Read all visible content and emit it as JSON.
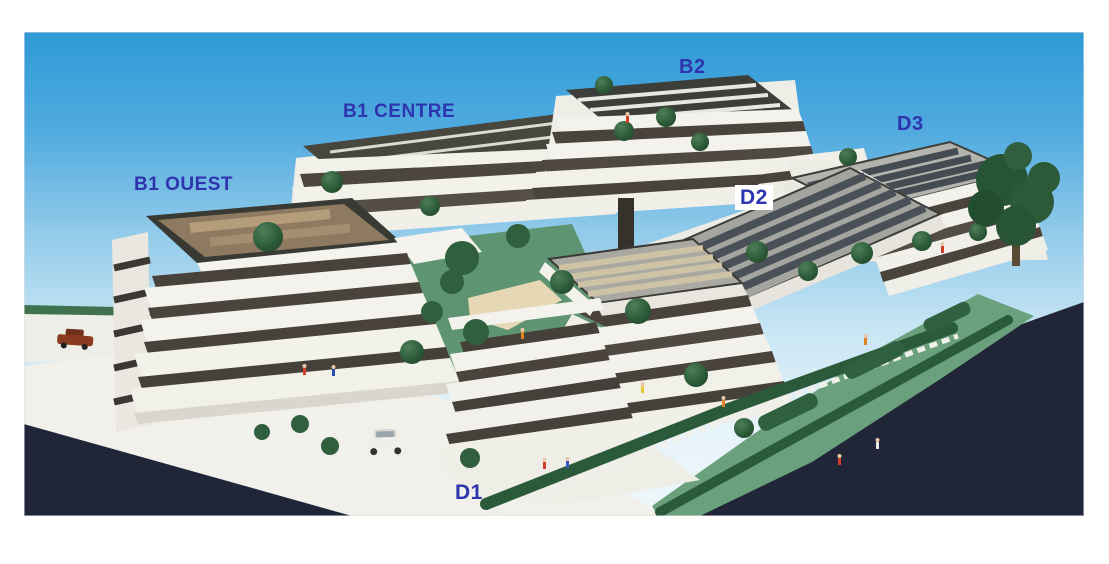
{
  "photo": {
    "description": "Photograph of an architectural scale model of a terraced apartment complex with labelled buildings",
    "labels": {
      "b1_ouest": "B1 OUEST",
      "b1_centre": "B1 CENTRE",
      "b2": "B2",
      "d2": "D2",
      "d3": "D3",
      "d1": "D1"
    },
    "label_style": "color:#2e34ae",
    "colors": {
      "label_blue": "#2e34ae",
      "sky_top": "#2f9ad6",
      "sky_mid": "#93cbea",
      "sky_horizon": "#edf7fb",
      "ground_dark": "#202638",
      "building_white": "#f3f2ec",
      "window_dark": "#48423a",
      "roof_deck_brown": "#8d7a60",
      "solar_panel": "#4a5058",
      "tree_green": "#2c5a38",
      "lawn_green": "#6aa07c",
      "hedge_green": "#2b5a3a",
      "sand_path": "#e7d8b5"
    }
  }
}
